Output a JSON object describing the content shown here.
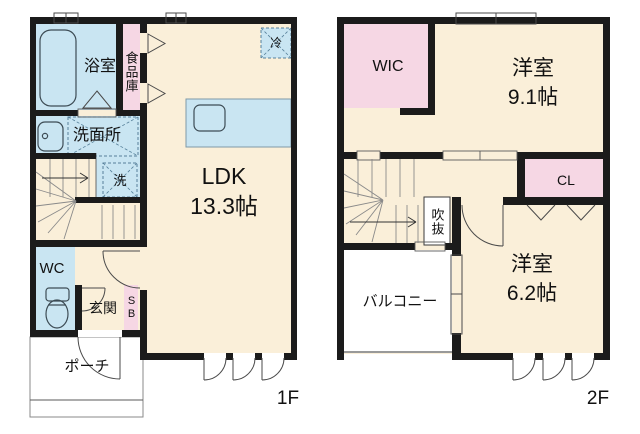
{
  "colors": {
    "wall": "#1b1b1b",
    "room_cream": "#faefd9",
    "room_blue": "#c9e5f2",
    "room_pink": "#f6d7e4"
  },
  "floor1": {
    "floor_label": "1F",
    "bathroom_label": "浴室",
    "pantry_label": "食品庫",
    "washroom_label": "洗面所",
    "washer_label": "洗",
    "fridge_label": "冷",
    "ldk_name": "LDK",
    "ldk_size": "13.3帖",
    "wc_label": "WC",
    "entrance_label": "玄関",
    "shoebox_label": "SB",
    "porch_label": "ポーチ"
  },
  "floor2": {
    "floor_label": "2F",
    "wic_label": "WIC",
    "bedroom1_name": "洋室",
    "bedroom1_size": "9.1帖",
    "closet_label": "CL",
    "void_label": "吹抜",
    "balcony_label": "バルコニー",
    "bedroom2_name": "洋室",
    "bedroom2_size": "6.2帖"
  }
}
